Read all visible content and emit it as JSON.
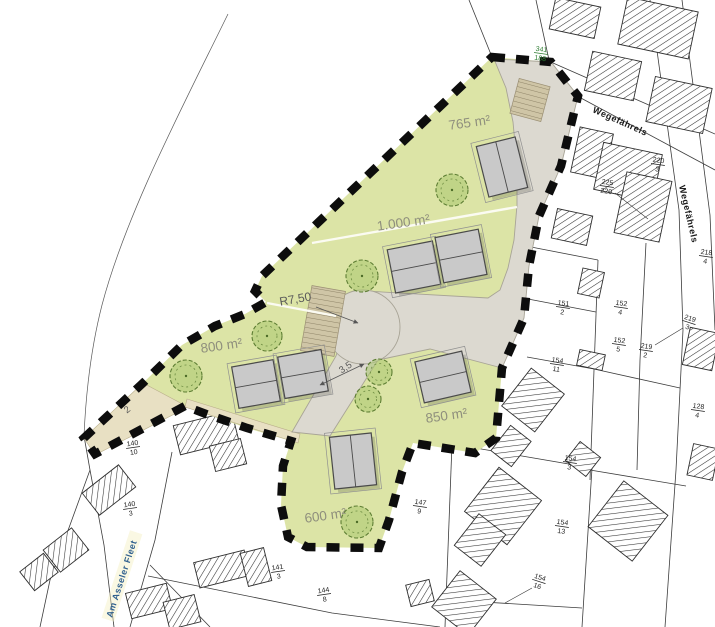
{
  "streets": {
    "wegefaehrels": "Wegefährels",
    "am_asseler_fleet": "Am Asseler Fleet"
  },
  "plots": [
    {
      "area_label": "765 m²"
    },
    {
      "area_label": "1.000 m²"
    },
    {
      "area_label": "800 m²"
    },
    {
      "area_label": "850 m²"
    },
    {
      "area_label": "600 m²"
    }
  ],
  "dimensions": {
    "turning_circle_radius": "R7,50",
    "driveway_width": "3,5",
    "path_width": "2"
  },
  "parcel_numbers": [
    {
      "top": "341",
      "bottom": "188"
    },
    {
      "top": "220",
      "bottom": "3"
    },
    {
      "top": "225",
      "bottom": "220"
    },
    {
      "top": "218",
      "bottom": "4"
    },
    {
      "top": "151",
      "bottom": "2"
    },
    {
      "top": "152",
      "bottom": "4"
    },
    {
      "top": "219",
      "bottom": "3"
    },
    {
      "top": "152",
      "bottom": "5"
    },
    {
      "top": "219",
      "bottom": "2"
    },
    {
      "top": "154",
      "bottom": "11"
    },
    {
      "top": "128",
      "bottom": "4"
    },
    {
      "top": "154",
      "bottom": "3"
    },
    {
      "top": "147",
      "bottom": "9"
    },
    {
      "top": "154",
      "bottom": "13"
    },
    {
      "top": "154",
      "bottom": "16"
    },
    {
      "top": "141",
      "bottom": "3"
    },
    {
      "top": "144",
      "bottom": "8"
    },
    {
      "top": "140",
      "bottom": "10"
    },
    {
      "top": "140",
      "bottom": "3"
    }
  ],
  "colors": {
    "plot_green": "#dce4a6",
    "road_grey": "#dcd9d0",
    "path_tan": "#e8e0c3",
    "hatch_tan": "#cfc5a6",
    "boundary_black": "#0d0d0d",
    "building_grey": "#c9c9c9",
    "parcel_number_green": "#2e7d32",
    "street_name_blue": "#31618f",
    "area_label_grey": "#8f8f7d"
  }
}
